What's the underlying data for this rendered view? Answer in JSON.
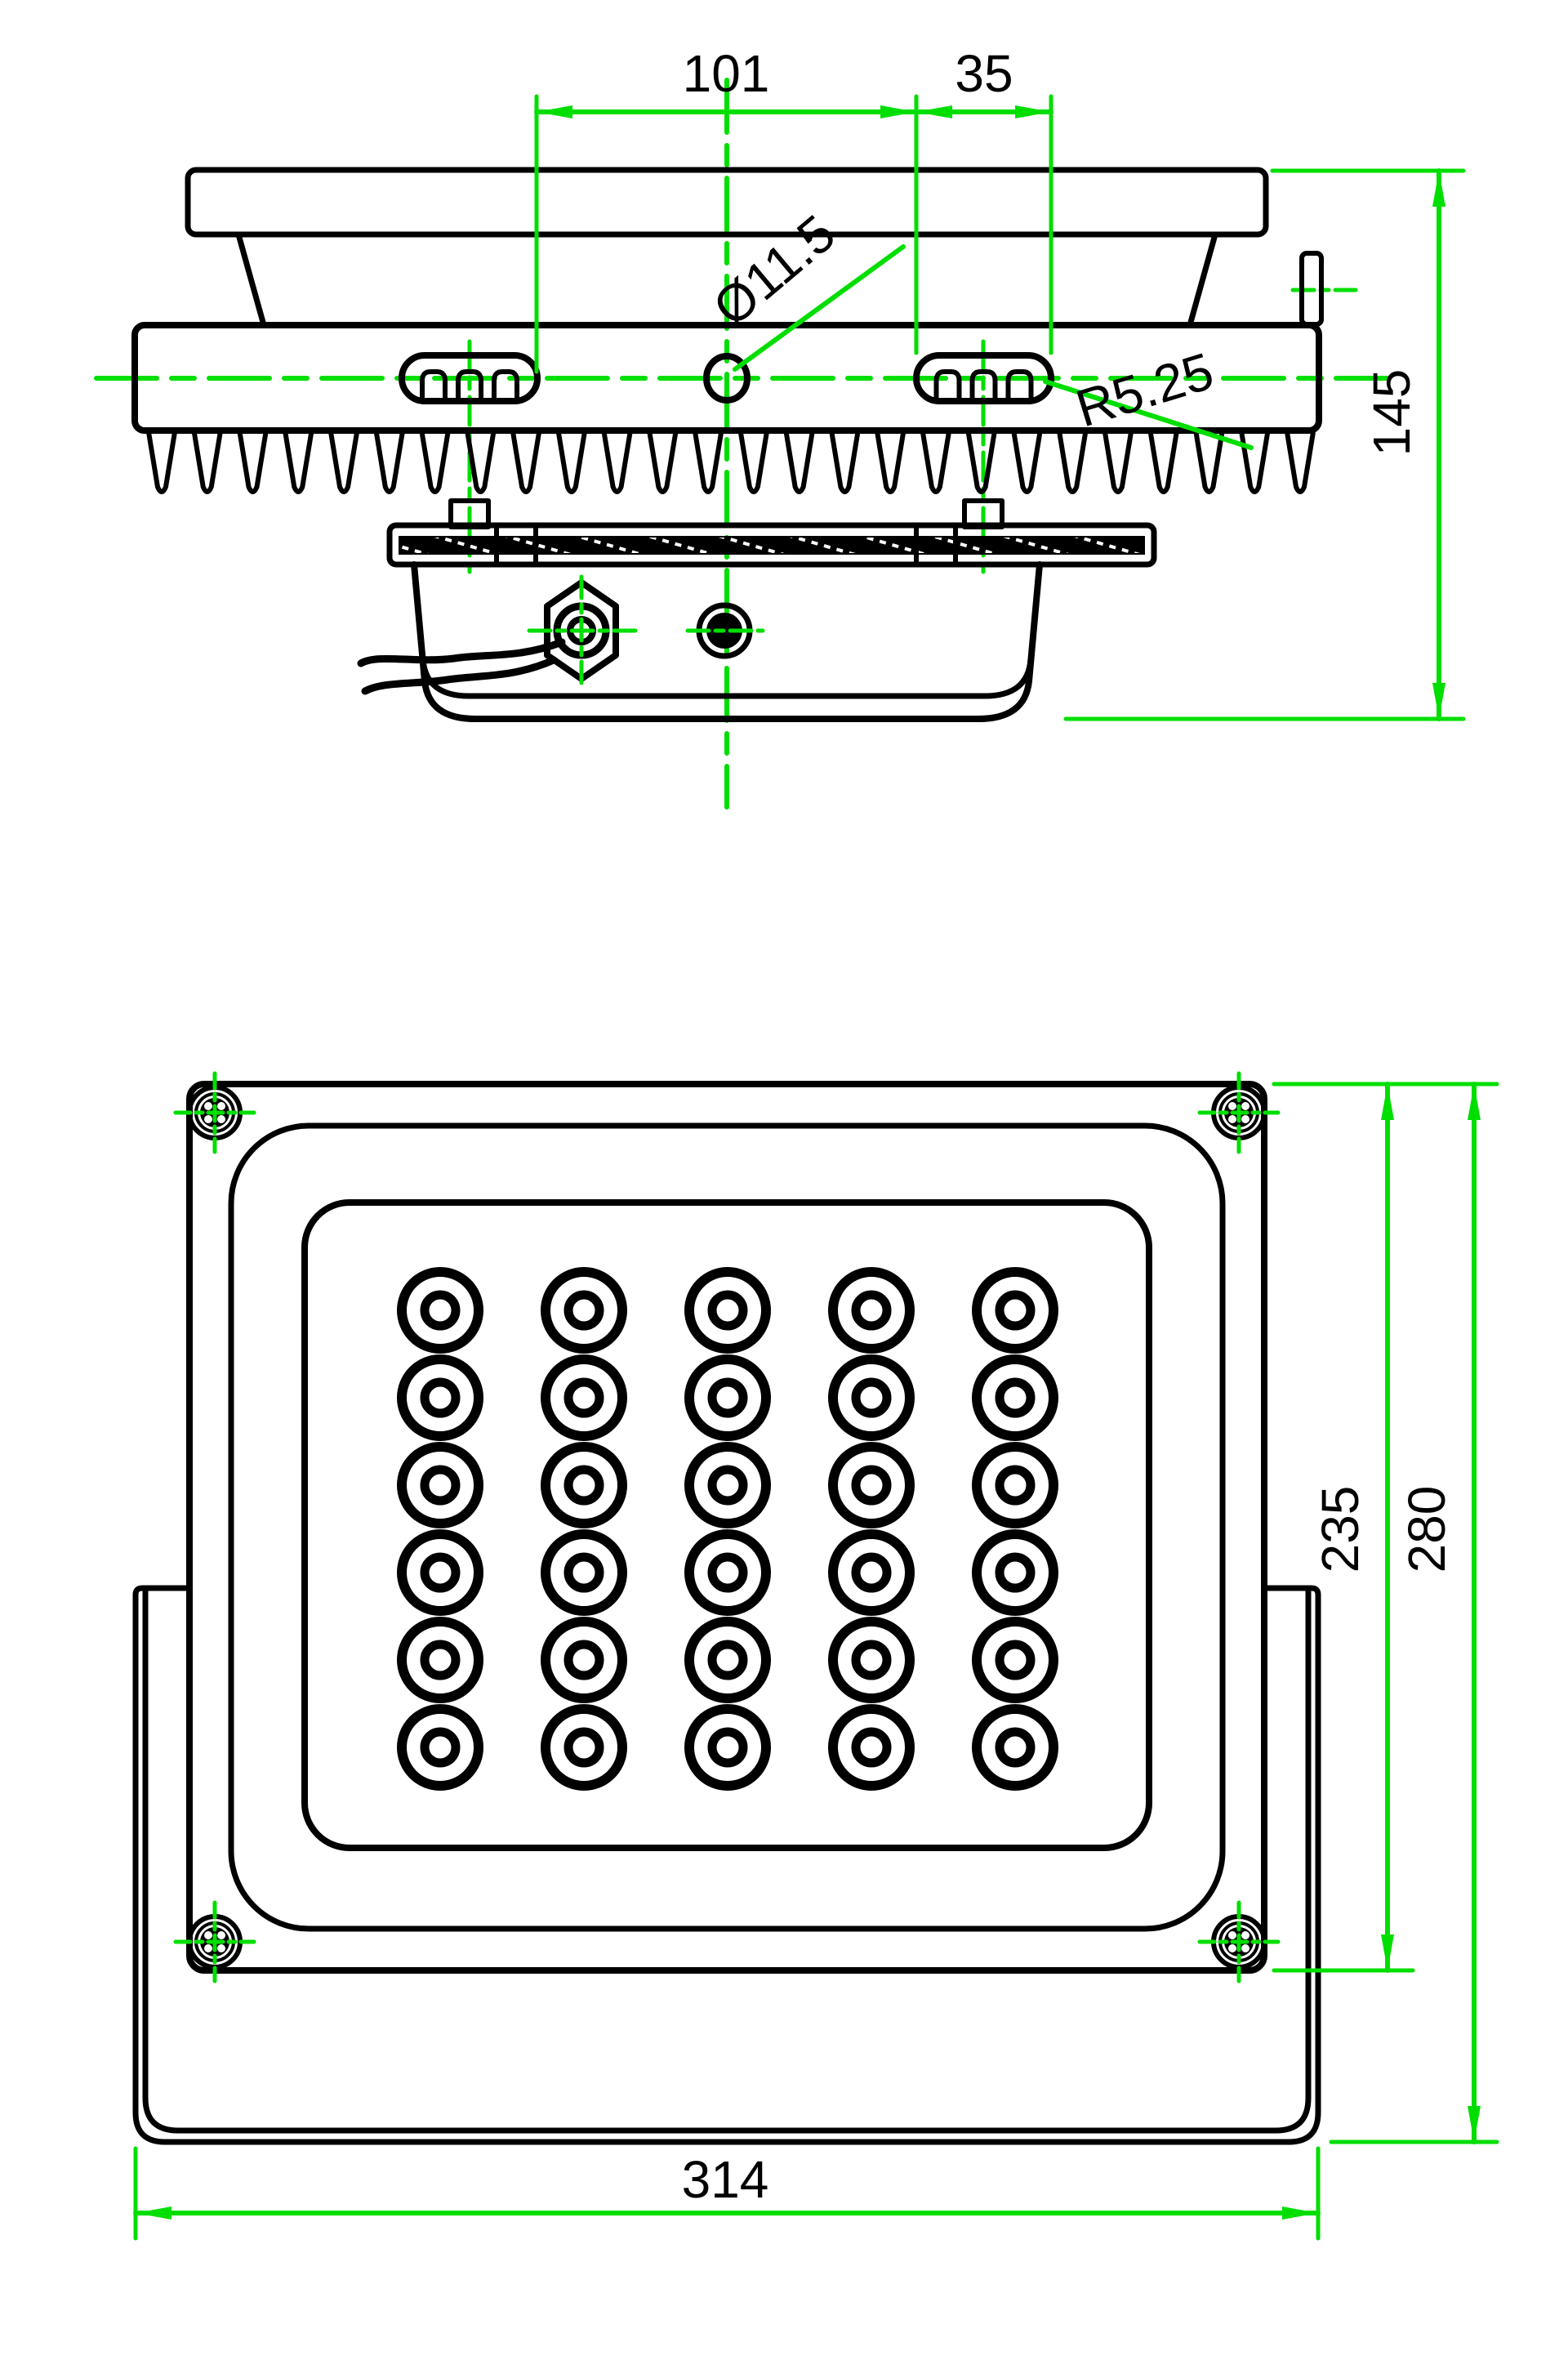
{
  "drawing": {
    "type": "technical-dimension-drawing",
    "subject": "LED floodlight",
    "units": "mm",
    "colors": {
      "outline": "#000000",
      "annotation_green": "#00DE00",
      "background": "#ffffff",
      "text": "#000000"
    },
    "side_view": {
      "dim_slot_spacing": {
        "label": "101"
      },
      "dim_slot_length": {
        "label": "35"
      },
      "dim_center_hole": {
        "label": "Ø11.5"
      },
      "dim_slot_radius": {
        "label": "R5.25"
      },
      "dim_overall_height": {
        "label": "145"
      },
      "features": {
        "mounting_slots": 2,
        "heatsink_fin_count": 26,
        "cable_count": 2,
        "has_cable_gland": true,
        "has_center_hole": true
      }
    },
    "front_view": {
      "dim_body_height": {
        "label": "235"
      },
      "dim_overall_height": {
        "label": "280"
      },
      "dim_bracket_width": {
        "label": "314"
      },
      "features": {
        "led_columns": 5,
        "led_rows": 6,
        "led_count": 30,
        "corner_screw_count": 4,
        "has_mounting_yoke": true
      }
    }
  }
}
